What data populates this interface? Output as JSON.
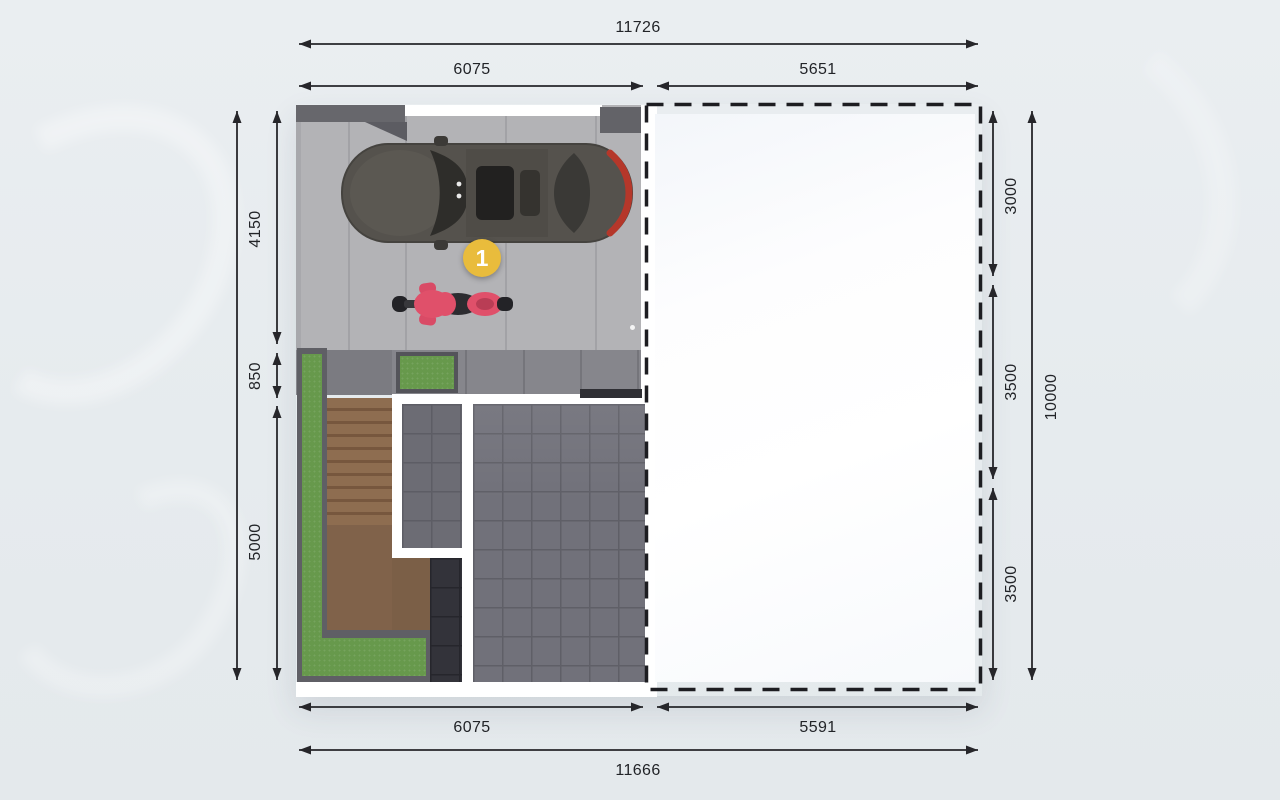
{
  "dimensions": {
    "top": {
      "total": "11726",
      "left": "6075",
      "right": "5651"
    },
    "bottom": {
      "left": "6075",
      "right": "5591",
      "total": "11666"
    },
    "left_segments": [
      "4150",
      "850",
      "5000"
    ],
    "right_segments": [
      "3000",
      "3500",
      "3500"
    ],
    "right_total": "10000"
  },
  "marker": {
    "label": "1",
    "color": "#e9bc3c"
  },
  "colors": {
    "background": "#e7ebee",
    "dimension_text": "#222428",
    "dimension_line": "#26262a",
    "driveway_concrete": "#b3b3b6",
    "wall_dark_gray": "#67676c",
    "terrace_tile": "#86868c",
    "grass_green": "#67994c",
    "stairs_brown": "#85664a",
    "interior_tile_gray": "#71717a",
    "interior_tile_black": "#33333a",
    "interior_wall_white": "#ffffff",
    "car_body": "#55524d",
    "car_taillight_red": "#b5372a",
    "motorcycle_pink": "#e0506a",
    "marker_yellow": "#e9bc3c",
    "dashed_outline": "#1d1d21"
  }
}
